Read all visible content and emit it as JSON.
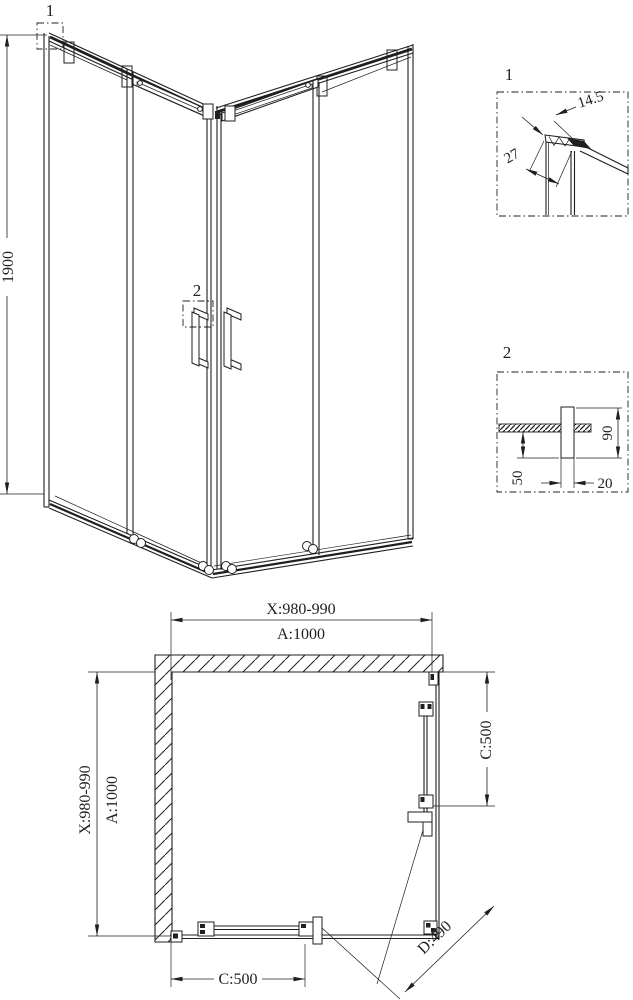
{
  "colors": {
    "line": "#1f1f1f",
    "background": "#ffffff"
  },
  "iso": {
    "height_dim": "1900",
    "callout1": "1",
    "callout2": "2"
  },
  "details": {
    "d1": {
      "label": "1",
      "dim_width": "14.5",
      "dim_depth": "27"
    },
    "d2": {
      "label": "2",
      "dim_height": "90",
      "dim_offset": "50",
      "dim_thickness": "20"
    }
  },
  "plan": {
    "top": {
      "x_range": "X:980-990",
      "a": "A:1000"
    },
    "left": {
      "x_range": "X:980-990",
      "a": "A:1000"
    },
    "right_c": "C:500",
    "bottom_c": "C:500",
    "diagonal_d": "D:490"
  }
}
